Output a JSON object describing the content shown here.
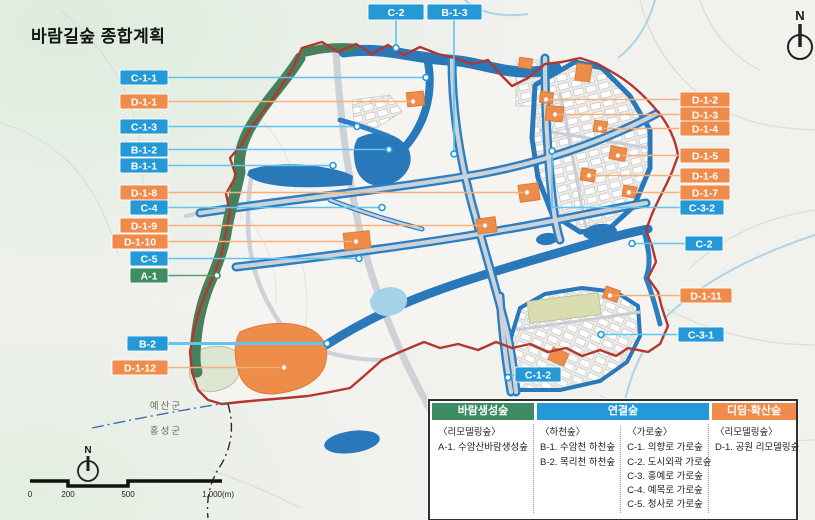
{
  "title": "바람길숲 종합계획",
  "compass": {
    "label": "N"
  },
  "compass_small": {
    "label": "N"
  },
  "region_labels": {
    "north_county": "예산군",
    "south_county": "홍성군"
  },
  "scalebar": {
    "t0": "0",
    "t1": "200",
    "t2": "500",
    "t3": "1,000(m)"
  },
  "colors": {
    "callout_blue": "#2599d8",
    "callout_orange": "#f08c4b",
    "callout_green": "#3e8d62",
    "leader_blue": "#5ec6ef",
    "leader_orange": "#f6b07c",
    "leader_green": "#55a077",
    "boundary_red": "#b4372f",
    "water_blue": "#2878ba",
    "street_forest_blue": "#2b7fc3",
    "forest_green": "#47815c",
    "park_orange": "#ee8c4a"
  },
  "callouts": [
    {
      "id": "C-2",
      "color": "blue",
      "box": [
        368,
        4,
        56,
        16
      ],
      "lead": [
        [
          396,
          20
        ],
        [
          396,
          48
        ]
      ],
      "anchor": [
        396,
        48
      ]
    },
    {
      "id": "B-1-3",
      "color": "blue",
      "box": [
        427,
        4,
        55,
        16
      ],
      "lead": [
        [
          454,
          20
        ],
        [
          454,
          154
        ]
      ],
      "anchor": [
        454,
        154
      ]
    },
    {
      "id": "C-1-1",
      "color": "blue",
      "box": [
        120,
        70,
        48,
        15
      ],
      "lead": [
        [
          168,
          77.5
        ],
        [
          426,
          77.5
        ]
      ],
      "anchor": [
        426,
        77.5
      ]
    },
    {
      "id": "D-1-1",
      "color": "orange",
      "box": [
        120,
        94,
        48,
        15
      ],
      "lead": [
        [
          168,
          101.5
        ],
        [
          413,
          101.5
        ]
      ],
      "anchor": [
        413,
        101.5
      ]
    },
    {
      "id": "C-1-3",
      "color": "blue",
      "box": [
        120,
        119,
        48,
        15
      ],
      "lead": [
        [
          168,
          126.5
        ],
        [
          357,
          126.5
        ]
      ],
      "anchor": [
        357,
        126.5
      ]
    },
    {
      "id": "B-1-2",
      "color": "blue",
      "box": [
        120,
        142,
        48,
        15
      ],
      "lead": [
        [
          168,
          149.5
        ],
        [
          389,
          149.5
        ]
      ],
      "anchor": [
        389,
        149.5
      ]
    },
    {
      "id": "B-1-1",
      "color": "blue",
      "box": [
        120,
        158,
        48,
        15
      ],
      "lead": [
        [
          168,
          165.5
        ],
        [
          333,
          165.5
        ]
      ],
      "anchor": [
        333,
        165.5
      ]
    },
    {
      "id": "D-1-8",
      "color": "orange",
      "box": [
        120,
        185,
        48,
        15
      ],
      "lead": [
        [
          168,
          192.5
        ],
        [
          527,
          192.5
        ]
      ],
      "anchor": [
        527,
        192.5
      ]
    },
    {
      "id": "C-4",
      "color": "blue",
      "box": [
        130,
        200,
        38,
        15
      ],
      "lead": [
        [
          168,
          207.5
        ],
        [
          382,
          207.5
        ]
      ],
      "anchor": [
        382,
        207.5
      ]
    },
    {
      "id": "D-1-9",
      "color": "orange",
      "box": [
        120,
        218,
        48,
        15
      ],
      "lead": [
        [
          168,
          225.5
        ],
        [
          485,
          225.5
        ]
      ],
      "anchor": [
        485,
        225.5
      ]
    },
    {
      "id": "D-1-10",
      "color": "orange",
      "box": [
        112,
        234,
        56,
        15
      ],
      "lead": [
        [
          168,
          241.5
        ],
        [
          356,
          241.5
        ]
      ],
      "anchor": [
        356,
        241.5
      ]
    },
    {
      "id": "C-5",
      "color": "blue",
      "box": [
        130,
        251,
        38,
        15
      ],
      "lead": [
        [
          168,
          258.5
        ],
        [
          359,
          258.5
        ]
      ],
      "anchor": [
        359,
        258.5
      ]
    },
    {
      "id": "A-1",
      "color": "green",
      "box": [
        130,
        268,
        38,
        15
      ],
      "lead": [
        [
          168,
          275.5
        ],
        [
          217,
          275.5
        ]
      ],
      "anchor": [
        217,
        275.5
      ]
    },
    {
      "id": "B-2",
      "color": "blue",
      "box": [
        127,
        336,
        41,
        15
      ],
      "lead": [
        [
          168,
          343.5
        ],
        [
          327,
          343.5
        ]
      ],
      "anchor": [
        327,
        343.5
      ],
      "thick": true
    },
    {
      "id": "D-1-12",
      "color": "orange",
      "box": [
        112,
        360,
        56,
        15
      ],
      "lead": [
        [
          168,
          367.5
        ],
        [
          284,
          367.5
        ]
      ],
      "anchor": [
        284,
        367.5
      ]
    },
    {
      "id": "D-1-2",
      "color": "orange",
      "box": [
        680,
        92,
        50,
        15
      ],
      "lead": [
        [
          680,
          99.5
        ],
        [
          546,
          99.5
        ]
      ],
      "anchor": [
        546,
        99.5
      ]
    },
    {
      "id": "D-1-3",
      "color": "orange",
      "box": [
        680,
        107,
        50,
        15
      ],
      "lead": [
        [
          680,
          114.5
        ],
        [
          555,
          114.5
        ]
      ],
      "anchor": [
        555,
        114.5
      ]
    },
    {
      "id": "D-1-4",
      "color": "orange",
      "box": [
        680,
        121,
        50,
        15
      ],
      "lead": [
        [
          680,
          128.5
        ],
        [
          600,
          128.5
        ]
      ],
      "anchor": [
        600,
        128.5
      ]
    },
    {
      "id": "D-1-5",
      "color": "orange",
      "box": [
        680,
        148,
        50,
        15
      ],
      "lead": [
        [
          680,
          155.5
        ],
        [
          618,
          155.5
        ]
      ],
      "anchor": [
        618,
        155.5
      ]
    },
    {
      "id": "D-1-6",
      "color": "orange",
      "box": [
        680,
        168,
        50,
        15
      ],
      "lead": [
        [
          680,
          175.5
        ],
        [
          589,
          175.5
        ]
      ],
      "anchor": [
        589,
        175.5
      ]
    },
    {
      "id": "D-1-7",
      "color": "orange",
      "box": [
        680,
        185,
        50,
        15
      ],
      "lead": [
        [
          680,
          192.5
        ],
        [
          629,
          192.5
        ]
      ],
      "anchor": [
        629,
        192.5
      ]
    },
    {
      "id": "C-3-2",
      "color": "blue",
      "box": [
        680,
        200,
        44,
        15
      ],
      "lead": [
        [
          680,
          207.5
        ],
        [
          552,
          207.5
        ],
        [
          552,
          151
        ]
      ],
      "anchor": [
        552,
        151
      ]
    },
    {
      "id": "C-2",
      "color": "blue",
      "box": [
        685,
        236,
        38,
        15
      ],
      "lead": [
        [
          685,
          243.5
        ],
        [
          632,
          243.5
        ]
      ],
      "anchor": [
        632,
        243.5
      ]
    },
    {
      "id": "D-1-11",
      "color": "orange",
      "box": [
        680,
        288,
        52,
        15
      ],
      "lead": [
        [
          680,
          295.5
        ],
        [
          610,
          295.5
        ]
      ],
      "anchor": [
        610,
        295.5
      ]
    },
    {
      "id": "C-3-1",
      "color": "blue",
      "box": [
        678,
        327,
        46,
        15
      ],
      "lead": [
        [
          678,
          334.5
        ],
        [
          601,
          334.5
        ]
      ],
      "anchor": [
        601,
        334.5
      ]
    },
    {
      "id": "C-1-2",
      "color": "blue",
      "box": [
        515,
        367,
        46,
        15
      ],
      "lead": [
        [
          515,
          374.5
        ],
        [
          508,
          377
        ]
      ],
      "anchor": [
        508,
        377.5
      ]
    }
  ],
  "legend": {
    "columns": [
      {
        "header": "바람생성숲",
        "color": "#3e8d62",
        "width": 102,
        "groups": [
          {
            "title": "〈리모델링숲〉",
            "items": [
              "A-1. 수암산바람생성숲"
            ]
          }
        ]
      },
      {
        "header": "연결숲",
        "color": "#2599d8",
        "width": 172,
        "groups": [
          {
            "title": "〈하천숲〉",
            "items": [
              "B-1. 수암천 하천숲",
              "B-2. 목리천 하천숲"
            ]
          },
          {
            "title": "〈가로숲〉",
            "items": [
              "C-1. 의향로 가로숲",
              "C-2. 도시외곽 가로숲",
              "C-3. 홍예로 가로숲",
              "C-4. 예목로 가로숲",
              "C-5. 청사로 가로숲"
            ]
          }
        ]
      },
      {
        "header": "디딤·확산숲",
        "color": "#f08c4b",
        "width": 84,
        "groups": [
          {
            "title": "〈리모델링숲〉",
            "items": [
              "D-1. 공원 리모델링숲"
            ]
          }
        ]
      }
    ]
  }
}
